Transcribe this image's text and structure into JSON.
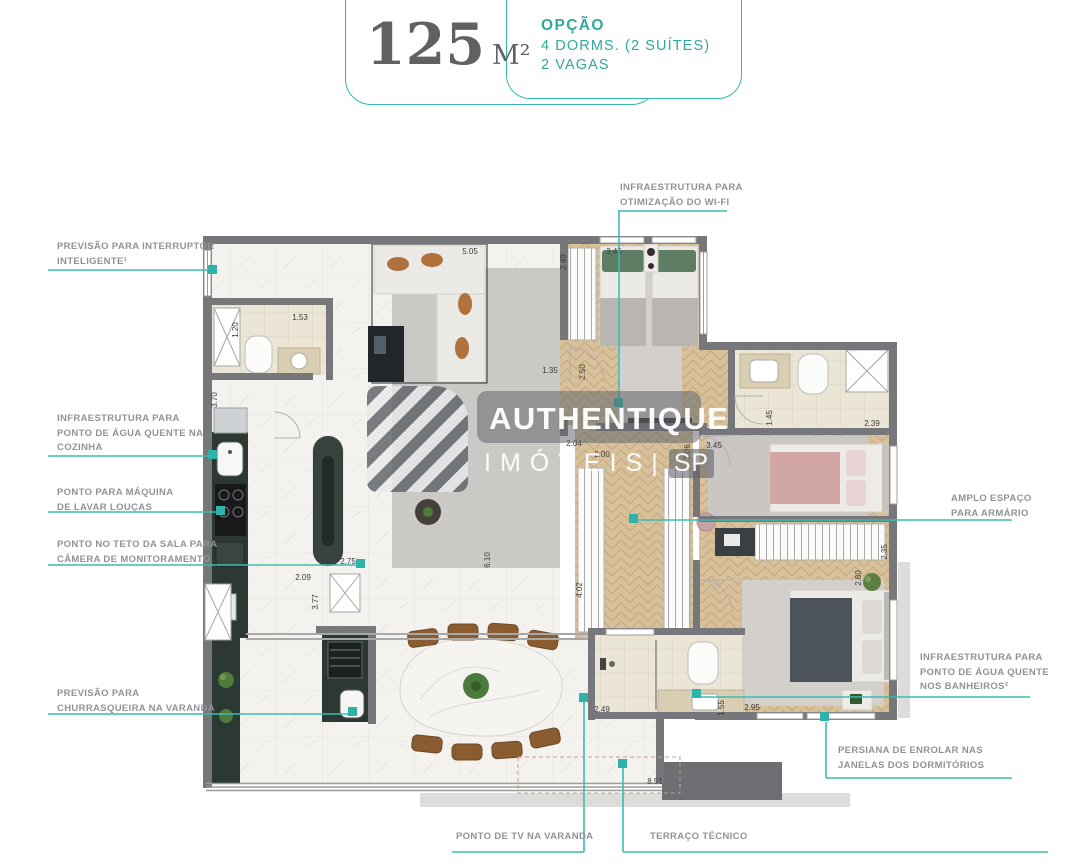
{
  "header": {
    "area_value": "125",
    "area_unit": "M²",
    "option_title": "OPÇÃO",
    "option_line1": "4 DORMS. (2 SUÍTES)",
    "option_line2": "2 VAGAS"
  },
  "watermark": {
    "brand": "AUTHENTIQUE",
    "sub1": "IMÓVEIS",
    "sep": "|",
    "sub2": "SP"
  },
  "annotations": {
    "left": [
      {
        "id": "interruptor-inteligente",
        "lines": [
          "PREVISÃO PARA INTERRUPTOR",
          "INTELIGENTE¹"
        ]
      },
      {
        "id": "agua-quente-cozinha",
        "lines": [
          "INFRAESTRUTURA PARA",
          "PONTO DE ÁGUA QUENTE NA",
          "COZINHA"
        ]
      },
      {
        "id": "maquina-lavar-loucas",
        "lines": [
          "PONTO PARA MÁQUINA",
          "DE LAVAR LOUÇAS"
        ]
      },
      {
        "id": "camera-monitoramento",
        "lines": [
          "PONTO NO TETO DA SALA PARA",
          "CÂMERA DE MONITORAMENTO"
        ]
      },
      {
        "id": "churrasqueira-varanda",
        "lines": [
          "PREVISÃO PARA",
          "CHURRASQUEIRA NA VARANDA"
        ]
      }
    ],
    "top": [
      {
        "id": "wifi",
        "lines": [
          "INFRAESTRUTURA PARA",
          "OTIMIZAÇÃO DO WI-FI"
        ]
      }
    ],
    "right": [
      {
        "id": "amplo-espaco-armario",
        "lines": [
          "AMPLO ESPAÇO",
          "PARA ARMÁRIO"
        ]
      },
      {
        "id": "agua-quente-banheiros",
        "lines": [
          "INFRAESTRUTURA PARA",
          "PONTO DE ÁGUA QUENTE",
          "NOS BANHEIROS²"
        ]
      },
      {
        "id": "persiana-enrolar",
        "lines": [
          "PERSIANA DE ENROLAR NAS",
          "JANELAS DOS DORMITÓRIOS"
        ]
      }
    ],
    "bottom": [
      {
        "id": "tv-varanda",
        "lines": [
          "PONTO DE TV NA VARANDA"
        ]
      },
      {
        "id": "terraco-tecnico",
        "lines": [
          "TERRAÇO TÉCNICO"
        ]
      }
    ]
  },
  "plan": {
    "dims": [
      "5.05",
      "1.20",
      "1.53",
      "3.70",
      "2.49",
      "3.45",
      "1.35",
      "2.50",
      "2.04",
      "2.00",
      "3.45",
      "1.45",
      "2.39",
      "2.35",
      "2.80",
      "2.95",
      "1.55",
      "2.49",
      "2.07",
      "2.09",
      "3.77",
      "2.75",
      "4.02",
      "6.10",
      "8.51",
      "3.06"
    ]
  },
  "colors": {
    "accent_teal": "#35b8ac",
    "marker_teal": "#2fb3a8",
    "label_gray": "#8f9397",
    "wall_gray": "#76777a",
    "title_gray": "#5f6163",
    "wood_floor": "#d8c09a",
    "counter_dark": "#2c3833"
  }
}
